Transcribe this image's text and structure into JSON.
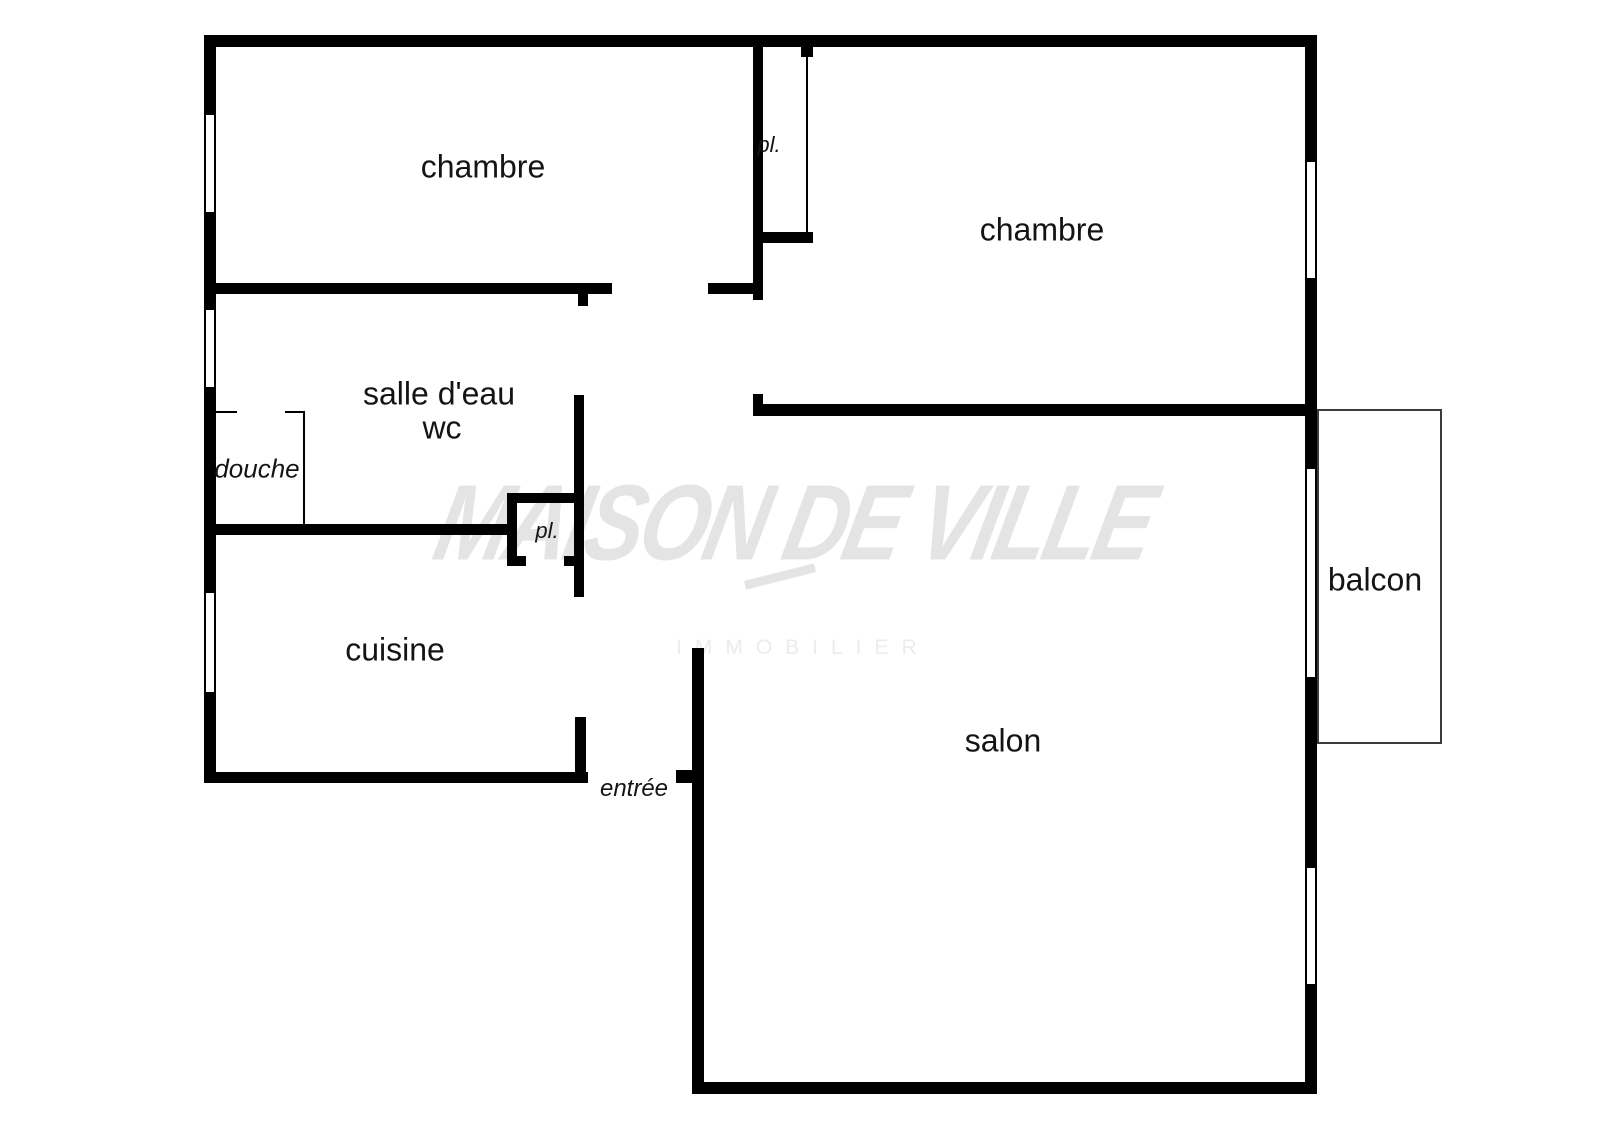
{
  "watermark": {
    "brand": "MAISON DE VILLE",
    "tagline": "IMMOBILIER"
  },
  "colors": {
    "wall": "#000000",
    "background": "#ffffff",
    "watermark_script": "#e4e4e4",
    "watermark_tagline": "#ececec",
    "label": "#141414",
    "balcony_line": "#3c3c3c"
  },
  "rooms": {
    "chambre_1": "chambre",
    "chambre_2": "chambre",
    "salle_deau": "salle d'eau",
    "wc": "wc",
    "douche": "douche",
    "cuisine": "cuisine",
    "salon": "salon",
    "balcon": "balcon",
    "entree": "entrée",
    "placard_1": "pl.",
    "placard_2": "pl."
  }
}
